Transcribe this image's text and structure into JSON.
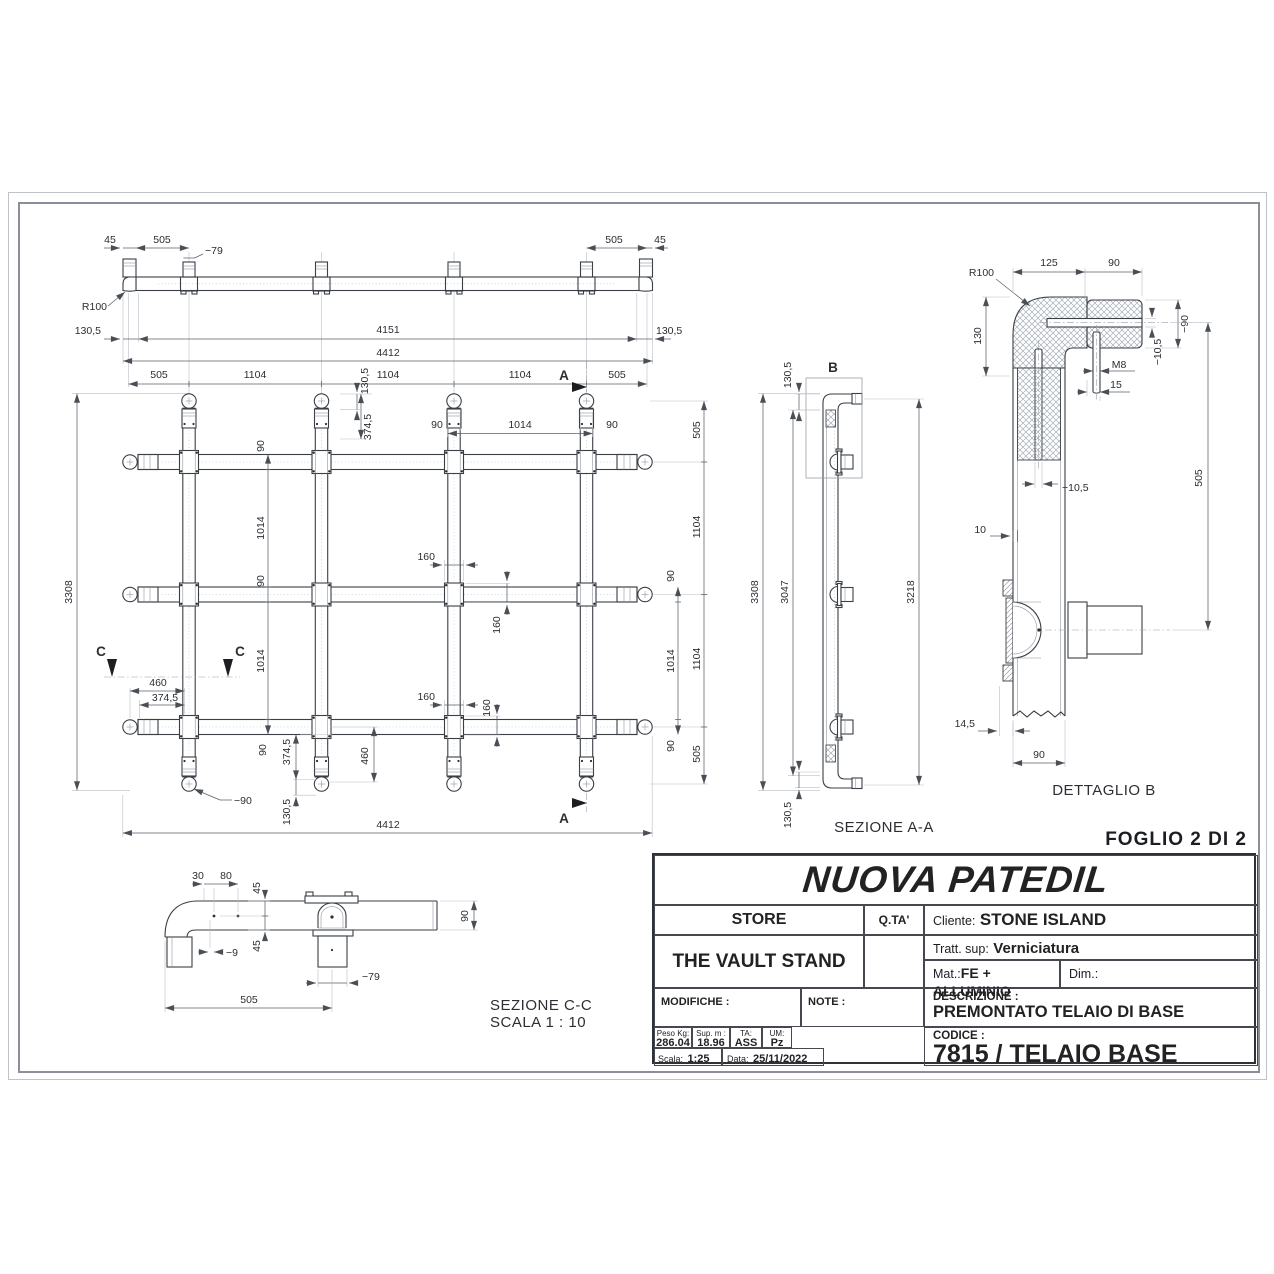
{
  "sheet": {
    "foglio": "FOGLIO 2 DI 2"
  },
  "front": {
    "d45l": "45",
    "d505l": "505",
    "dia79": "−79",
    "d505r": "505",
    "d45r": "45",
    "r100": "R100",
    "d1305l": "130,5",
    "d4151": "4151",
    "d1305r": "130,5",
    "d4412": "4412",
    "row": [
      "505",
      "1104",
      "1104",
      "1104",
      "505"
    ]
  },
  "plan": {
    "a": "A",
    "c": "C",
    "d3308": "3308",
    "d1305_top": "130,5",
    "d3745_top": "374,5",
    "t90l": "90",
    "t1014": "1014",
    "t90r": "90",
    "lc": [
      "90",
      "1014",
      "90",
      "1014",
      "90"
    ],
    "ri": [
      "90",
      "1014",
      "90"
    ],
    "ro": [
      "505",
      "1104",
      "1104",
      "505"
    ],
    "d160a": "160",
    "d160b": "160",
    "d160c": "160",
    "d160d": "160",
    "d460l": "460",
    "d3745l": "374,5",
    "dia90": "−90",
    "d3745r": "374,5",
    "d1305b": "130,5",
    "d460r": "460",
    "d4412": "4412"
  },
  "aa": {
    "b": "B",
    "d1305t": "130,5",
    "d3308": "3308",
    "d3047": "3047",
    "d3218": "3218",
    "d1305b": "130,5",
    "label": "SEZIONE A-A"
  },
  "db": {
    "r100": "R100",
    "d125": "125",
    "d90t": "90",
    "d130": "130",
    "dia90": "−90",
    "dia105a": "−10,5",
    "m8": "M8",
    "d15": "15",
    "dia105b": "−10,5",
    "d505": "505",
    "d10": "10",
    "d145": "14,5",
    "d90b": "90",
    "label": "DETTAGLIO B"
  },
  "cc": {
    "d30": "30",
    "d80": "80",
    "d45a": "45",
    "d45b": "45",
    "dia9": "−9",
    "dia79": "−79",
    "d505": "505",
    "d90": "90",
    "label": "SEZIONE C-C",
    "scale": "SCALA 1 : 10"
  },
  "tb": {
    "brand": "NUOVA PATEDIL",
    "store": "STORE",
    "qta": "Q.TA'",
    "cliente_label": "Cliente:",
    "cliente": "STONE ISLAND",
    "product": "THE VAULT STAND",
    "tratt_label": "Tratt. sup:",
    "tratt": "Verniciatura",
    "mat_label": "Mat.:",
    "mat": "FE + ALLUMINIO",
    "dim_label": "Dim.:",
    "modifiche": "MODIFICHE :",
    "note": "NOTE :",
    "descrizione_label": "DESCRIZIONE :",
    "descrizione": "PREMONTATO TELAIO DI BASE",
    "peso_label": "Peso Kg:",
    "peso": "286.04",
    "sup_label": "Sup. m :",
    "sup": "18.96",
    "ta_label": "TA:",
    "ta": "ASS",
    "um_label": "UM:",
    "um": "Pz",
    "scala_label": "Scala:",
    "scala": "1:25",
    "data_label": "Data:",
    "data": "25/11/2022",
    "codice_label": "CODICE :",
    "codice": "7815 / TELAIO BASE"
  }
}
